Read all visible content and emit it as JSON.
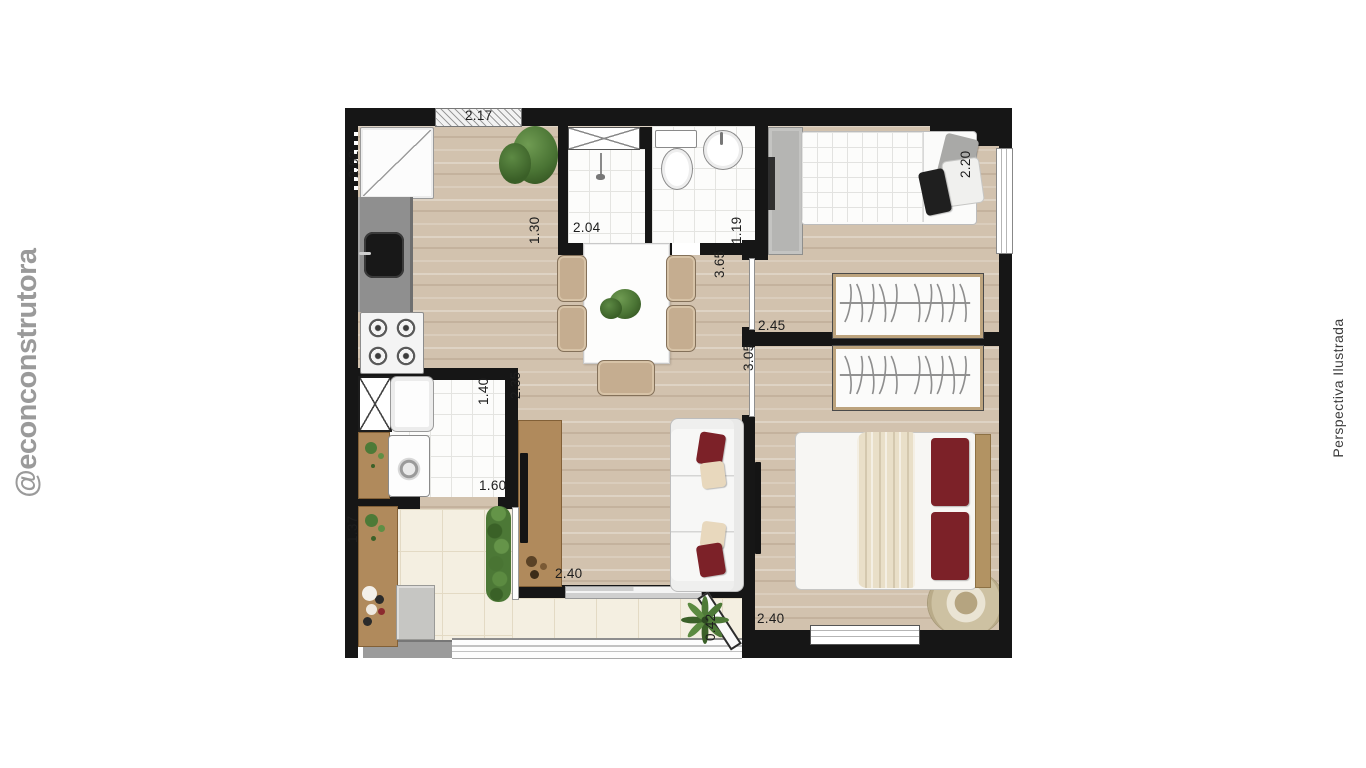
{
  "watermarks": {
    "handle_prefix": "@econ",
    "handle_suffix": "construtora",
    "caption": "Perspectiva Ilustrada"
  },
  "dimensions": {
    "kitchen_side": "2.62",
    "kitchen_front": "2.17",
    "shower_depth": "1.30",
    "shower_width": "2.04",
    "bathroom_width": "1.19",
    "living_hall": "3.65",
    "bedroom1_width": "2.20",
    "bedroom1_depth": "2.45",
    "bedroom2_depth": "3.05",
    "living_width": "2.35",
    "laundry_width": "1.40",
    "laundry_depth": "1.60",
    "balcony_depth": "1.37",
    "balcony_width": "2.40",
    "balcony_corner": "0.42",
    "bedroom2_width": "2.40"
  },
  "colors": {
    "wall": "#161616",
    "wood-floor": "#d2c2ae",
    "tile-floor": "#f4efe1",
    "tile-line": "#e3dac4",
    "bath-tile": "#fcfcfb",
    "bath-line": "#e4e4e1",
    "counter": "#8f8f8f",
    "furniture-wood": "#b08a5c",
    "chair-tan": "#c5ad90",
    "pillow-red": "#7c2128",
    "pillow-cream": "#e8d8bd",
    "blanket": "#e9dfc8",
    "plant-green": "#41682f",
    "wardrobe-gray": "#b5b5b3",
    "watermark-gray": "#9a9a9a",
    "label-ink": "#1e1e1e"
  }
}
